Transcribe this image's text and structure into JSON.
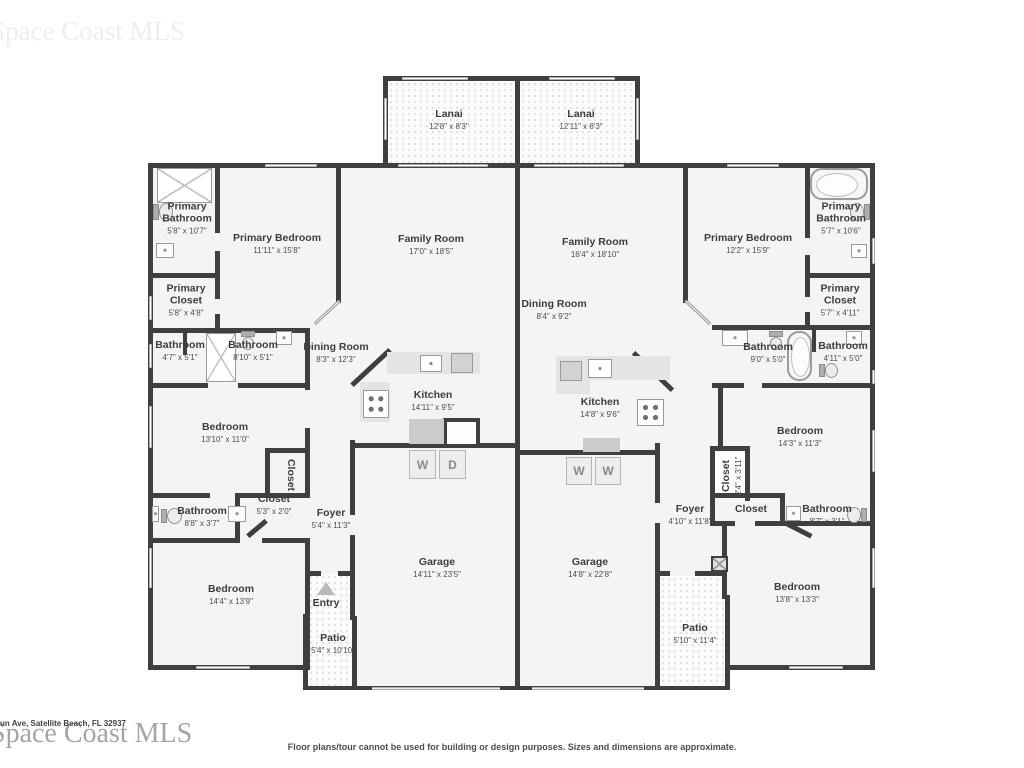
{
  "watermarks": {
    "top": "Space Coast MLS",
    "bottom": "Space Coast MLS"
  },
  "address": "un Ave, Satellite Beach, FL 32937",
  "disclaimer": "Floor plans/tour cannot be used for building or design purposes. Sizes and dimensions are approximate.",
  "appliances": {
    "washer": "W",
    "dryer": "D"
  },
  "colors": {
    "wall": "#3f3f3f",
    "room_fill": "#f4f4f4",
    "label_text": "#3d3d3d",
    "dim_text": "#4d4d4d",
    "counter": "#e4e4e4",
    "texture_dot": "#e2e2e2"
  },
  "rooms": [
    {
      "name": "Lanai",
      "dims": "12'8\" x 8'3\""
    },
    {
      "name": "Lanai",
      "dims": "12'11\" x 8'3\""
    },
    {
      "name": "Primary Bathroom",
      "dims": "5'8\" x 10'7\""
    },
    {
      "name": "Primary Bedroom",
      "dims": "11'11\" x 15'8\""
    },
    {
      "name": "Family Room",
      "dims": "17'0\" x 18'5\""
    },
    {
      "name": "Primary Closet",
      "dims": "5'8\" x 4'8\""
    },
    {
      "name": "Bathroom",
      "dims": "4'7\" x 5'1\""
    },
    {
      "name": "Bathroom",
      "dims": "8'10\" x 5'1\""
    },
    {
      "name": "Dining Room",
      "dims": "8'3\" x 12'3\""
    },
    {
      "name": "Kitchen",
      "dims": "14'11\" x 9'5\""
    },
    {
      "name": "Bedroom",
      "dims": "13'10\" x 11'0\""
    },
    {
      "name": "Closet",
      "dims": ""
    },
    {
      "name": "Closet",
      "dims": "5'3\" x 2'0\""
    },
    {
      "name": "Bathroom",
      "dims": "8'8\" x 3'7\""
    },
    {
      "name": "Foyer",
      "dims": "5'4\" x 11'3\""
    },
    {
      "name": "Garage",
      "dims": "14'11\" x 23'5\""
    },
    {
      "name": "Entry",
      "dims": ""
    },
    {
      "name": "Patio",
      "dims": "5'4\" x 10'10\""
    },
    {
      "name": "Bedroom",
      "dims": "14'4\" x 13'9\""
    },
    {
      "name": "Family Room",
      "dims": "16'4\" x 18'10\""
    },
    {
      "name": "Dining Room",
      "dims": "8'4\" x 9'2\""
    },
    {
      "name": "Primary Bedroom",
      "dims": "12'2\" x 15'9\""
    },
    {
      "name": "Primary Bathroom",
      "dims": "5'7\" x 10'6\""
    },
    {
      "name": "Primary Closet",
      "dims": "5'7\" x 4'11\""
    },
    {
      "name": "Bathroom",
      "dims": "9'0\" x 5'0\""
    },
    {
      "name": "Bathroom",
      "dims": "4'11\" x 5'0\""
    },
    {
      "name": "Kitchen",
      "dims": "14'8\" x 9'6\""
    },
    {
      "name": "Bedroom",
      "dims": "14'3\" x 11'3\""
    },
    {
      "name": "Closet",
      "dims": "2'4\" x 3'11\""
    },
    {
      "name": "Closet",
      "dims": ""
    },
    {
      "name": "Foyer",
      "dims": "4'10\" x 11'8\""
    },
    {
      "name": "Garage",
      "dims": "14'8\" x 22'8\""
    },
    {
      "name": "Bathroom",
      "dims": "8'7\" x 3'1\""
    },
    {
      "name": "Bedroom",
      "dims": "13'8\" x 13'3\""
    },
    {
      "name": "Patio",
      "dims": "5'10\" x 11'4\""
    }
  ]
}
